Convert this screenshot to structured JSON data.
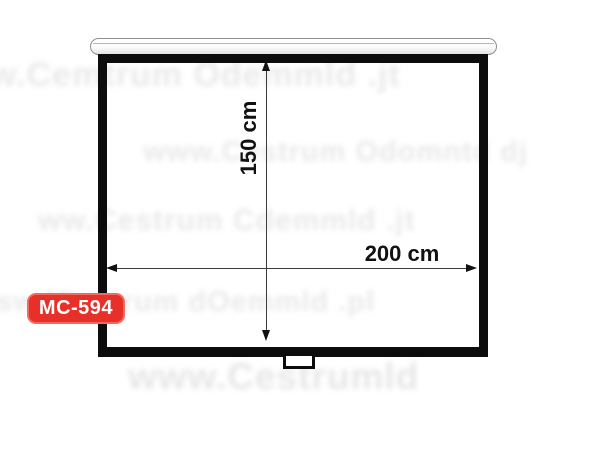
{
  "image": {
    "description": "Dimension diagram of a wall-mounted pull-down projection screen",
    "background_color": "#ffffff"
  },
  "product": {
    "model": "MC-594"
  },
  "badge": {
    "label": "MC-594",
    "background_color": "#e7302a",
    "border_color": "#f1695f",
    "text_color": "#ffffff"
  },
  "diagram": {
    "type": "dimension-diagram",
    "screen": {
      "frame_color": "#0c0c0c",
      "surface_color": "#ffffff",
      "casing_color": "#eeeeee",
      "arrow_color": "#111111"
    },
    "dimensions": {
      "height": {
        "label": "150 cm",
        "value_cm": 150,
        "orientation": "vertical"
      },
      "width": {
        "label": "200 cm",
        "value_cm": 200,
        "orientation": "horizontal"
      }
    }
  },
  "watermark": {
    "color": "#e9e9e9",
    "legible_fragments": [
      "w.Ce",
      "www.",
      "www.Ce",
      ".jt",
      ".pl"
    ],
    "bands": [
      {
        "text": "w.Cemtrum Odemmld .jt"
      },
      {
        "text": "www.Cestrum Odomntd dj"
      },
      {
        "text": "ww.Cestrum Cdemmld .jt"
      },
      {
        "text": "sw lCestrum dOemmld .pl"
      },
      {
        "text": "www.Cestrumld"
      }
    ]
  }
}
